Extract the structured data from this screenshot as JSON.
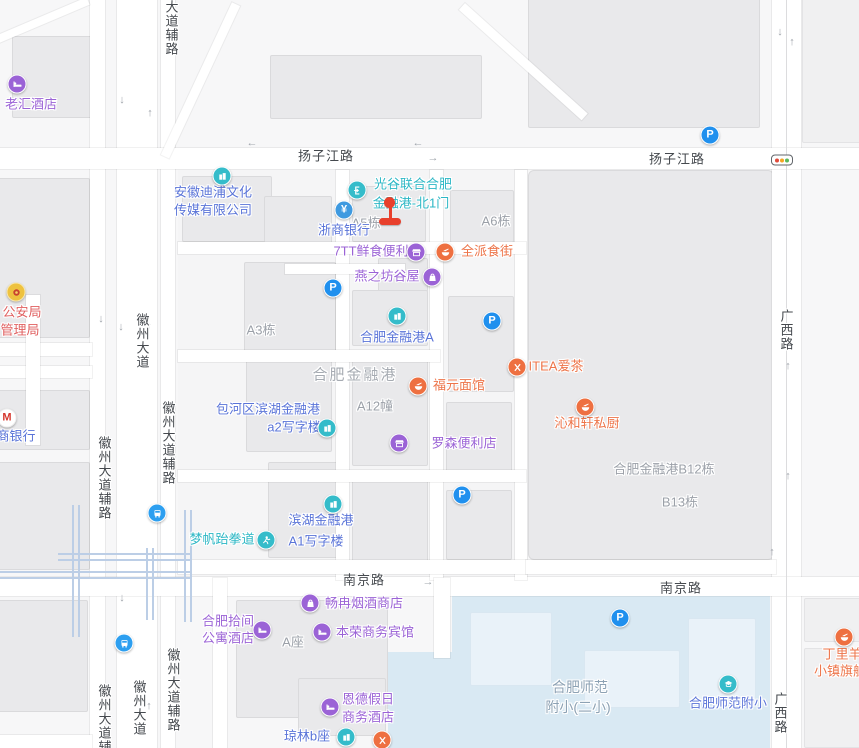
{
  "map": {
    "roads": {
      "yangzijiang": "扬子江路",
      "nanjing": "南京路",
      "guangxi": "广西路",
      "huizhou_dadao": "徽州大道",
      "huizhou_dadao_fulu": "徽州大道辅路",
      "dadao_fulu_partial": "大道辅路"
    },
    "areas": {
      "jinronggang": "合肥金融港",
      "b12": "合肥金融港B12栋",
      "b13": "B13栋",
      "a3": "A3栋",
      "a5": "A5栋",
      "a6": "A6栋",
      "a12": "A12幢",
      "azuo": "A座",
      "school_line1": "合肥师范",
      "school_line2": "附小(二小)"
    },
    "pois": {
      "guanggu": {
        "line1": "光谷联合合肥",
        "line2": "金融港-北1门"
      },
      "andipu": {
        "line1": "安徽迪浦文化",
        "line2": "传媒有限公司"
      },
      "zheshang": {
        "name": "浙商银行"
      },
      "laohui": {
        "name": "老汇酒店"
      },
      "gongan": {
        "line1": "公安局",
        "line2": "管理局"
      },
      "zhaoshang": {
        "name": "商银行"
      },
      "qtt": {
        "name": "7TT鲜食便利"
      },
      "quanpai": {
        "name": "全派食街"
      },
      "yanzhifang": {
        "name": "燕之坊谷屋"
      },
      "jinronggang_a": {
        "name": "合肥金融港A"
      },
      "fuyuan": {
        "name": "福元面馆"
      },
      "itea": {
        "name": "ITEA爱茶"
      },
      "qinhexuan": {
        "name": "沁和轩私厨"
      },
      "baohe": {
        "line1": "包河区滨湖金融港",
        "line2": "a2写字楼"
      },
      "luosen": {
        "name": "罗森便利店"
      },
      "binhu": {
        "line1": "滨湖金融港",
        "line2": "A1写字楼"
      },
      "mengfan": {
        "name": "梦帆跆拳道"
      },
      "changran": {
        "name": "畅冉烟酒商店"
      },
      "shijian": {
        "line1": "合肥拾间",
        "line2": "公寓酒店"
      },
      "benrong": {
        "name": "本荣商务宾馆"
      },
      "ende": {
        "line1": "恩德假日",
        "line2": "商务酒店"
      },
      "qionglin": {
        "name": "琼林b座"
      },
      "shifan_fuxiao": {
        "name": "合肥师范附小"
      },
      "dingliyang": {
        "line1": "丁里羊",
        "line2": "小镇旗舰"
      }
    },
    "icon_letters": {
      "parking": "P",
      "yuan": "¥",
      "cmb": "M"
    },
    "colors": {
      "teal": "#2cb7c5",
      "blue": "#5a74d8",
      "purple": "#9b63d6",
      "orange": "#ed7449",
      "parking_blue": "#2090ee",
      "marker_red": "#e8402c",
      "school_area": "#d9e9f3"
    }
  }
}
